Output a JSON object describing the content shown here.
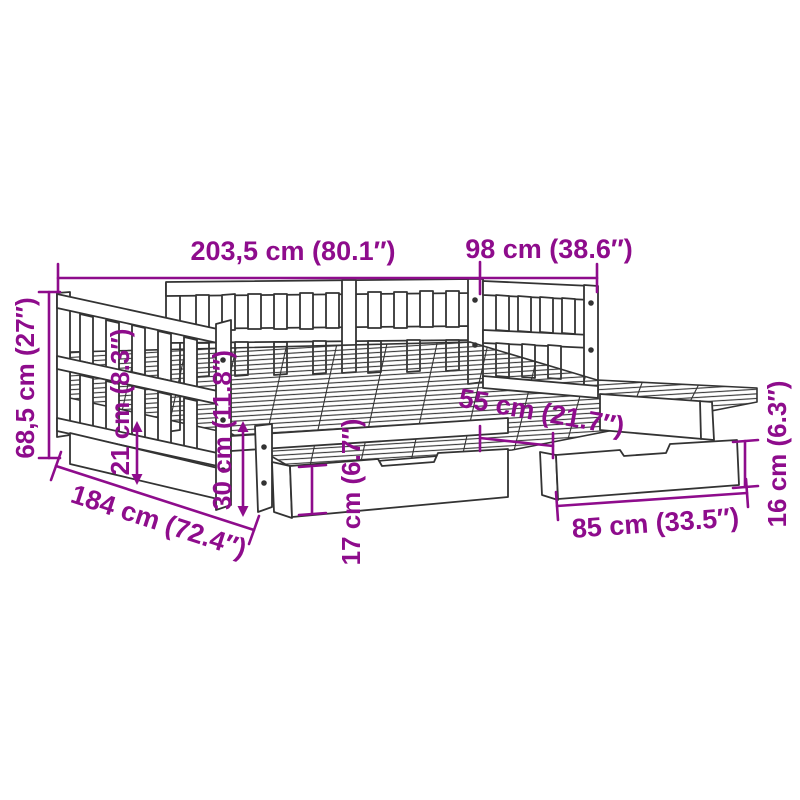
{
  "diagram": {
    "type": "product-dimension-drawing",
    "subject": "daybed with pull-out trundle bed and two storage drawers",
    "colors": {
      "dimension_accent": "#8E0C8C",
      "drawing_line": "#333333",
      "background": "#ffffff"
    },
    "dimensions": [
      {
        "id": "total-length",
        "label": "203,5 cm (80.1″)"
      },
      {
        "id": "total-width",
        "label": "98 cm (38.6″)"
      },
      {
        "id": "total-height",
        "label": "68,5 cm (27″)"
      },
      {
        "id": "trundle-length",
        "label": "184 cm (72.4″)"
      },
      {
        "id": "leg-clearance",
        "label": "21 cm (8.3″)"
      },
      {
        "id": "under-bed-height",
        "label": "30 cm (11.8″)"
      },
      {
        "id": "trundle-height",
        "label": "17 cm (6.7″)"
      },
      {
        "id": "drawer-depth",
        "label": "55 cm (21.7″)"
      },
      {
        "id": "drawer-width",
        "label": "85 cm (33.5″)"
      },
      {
        "id": "drawer-height",
        "label": "16 cm (6.3″)"
      }
    ]
  }
}
